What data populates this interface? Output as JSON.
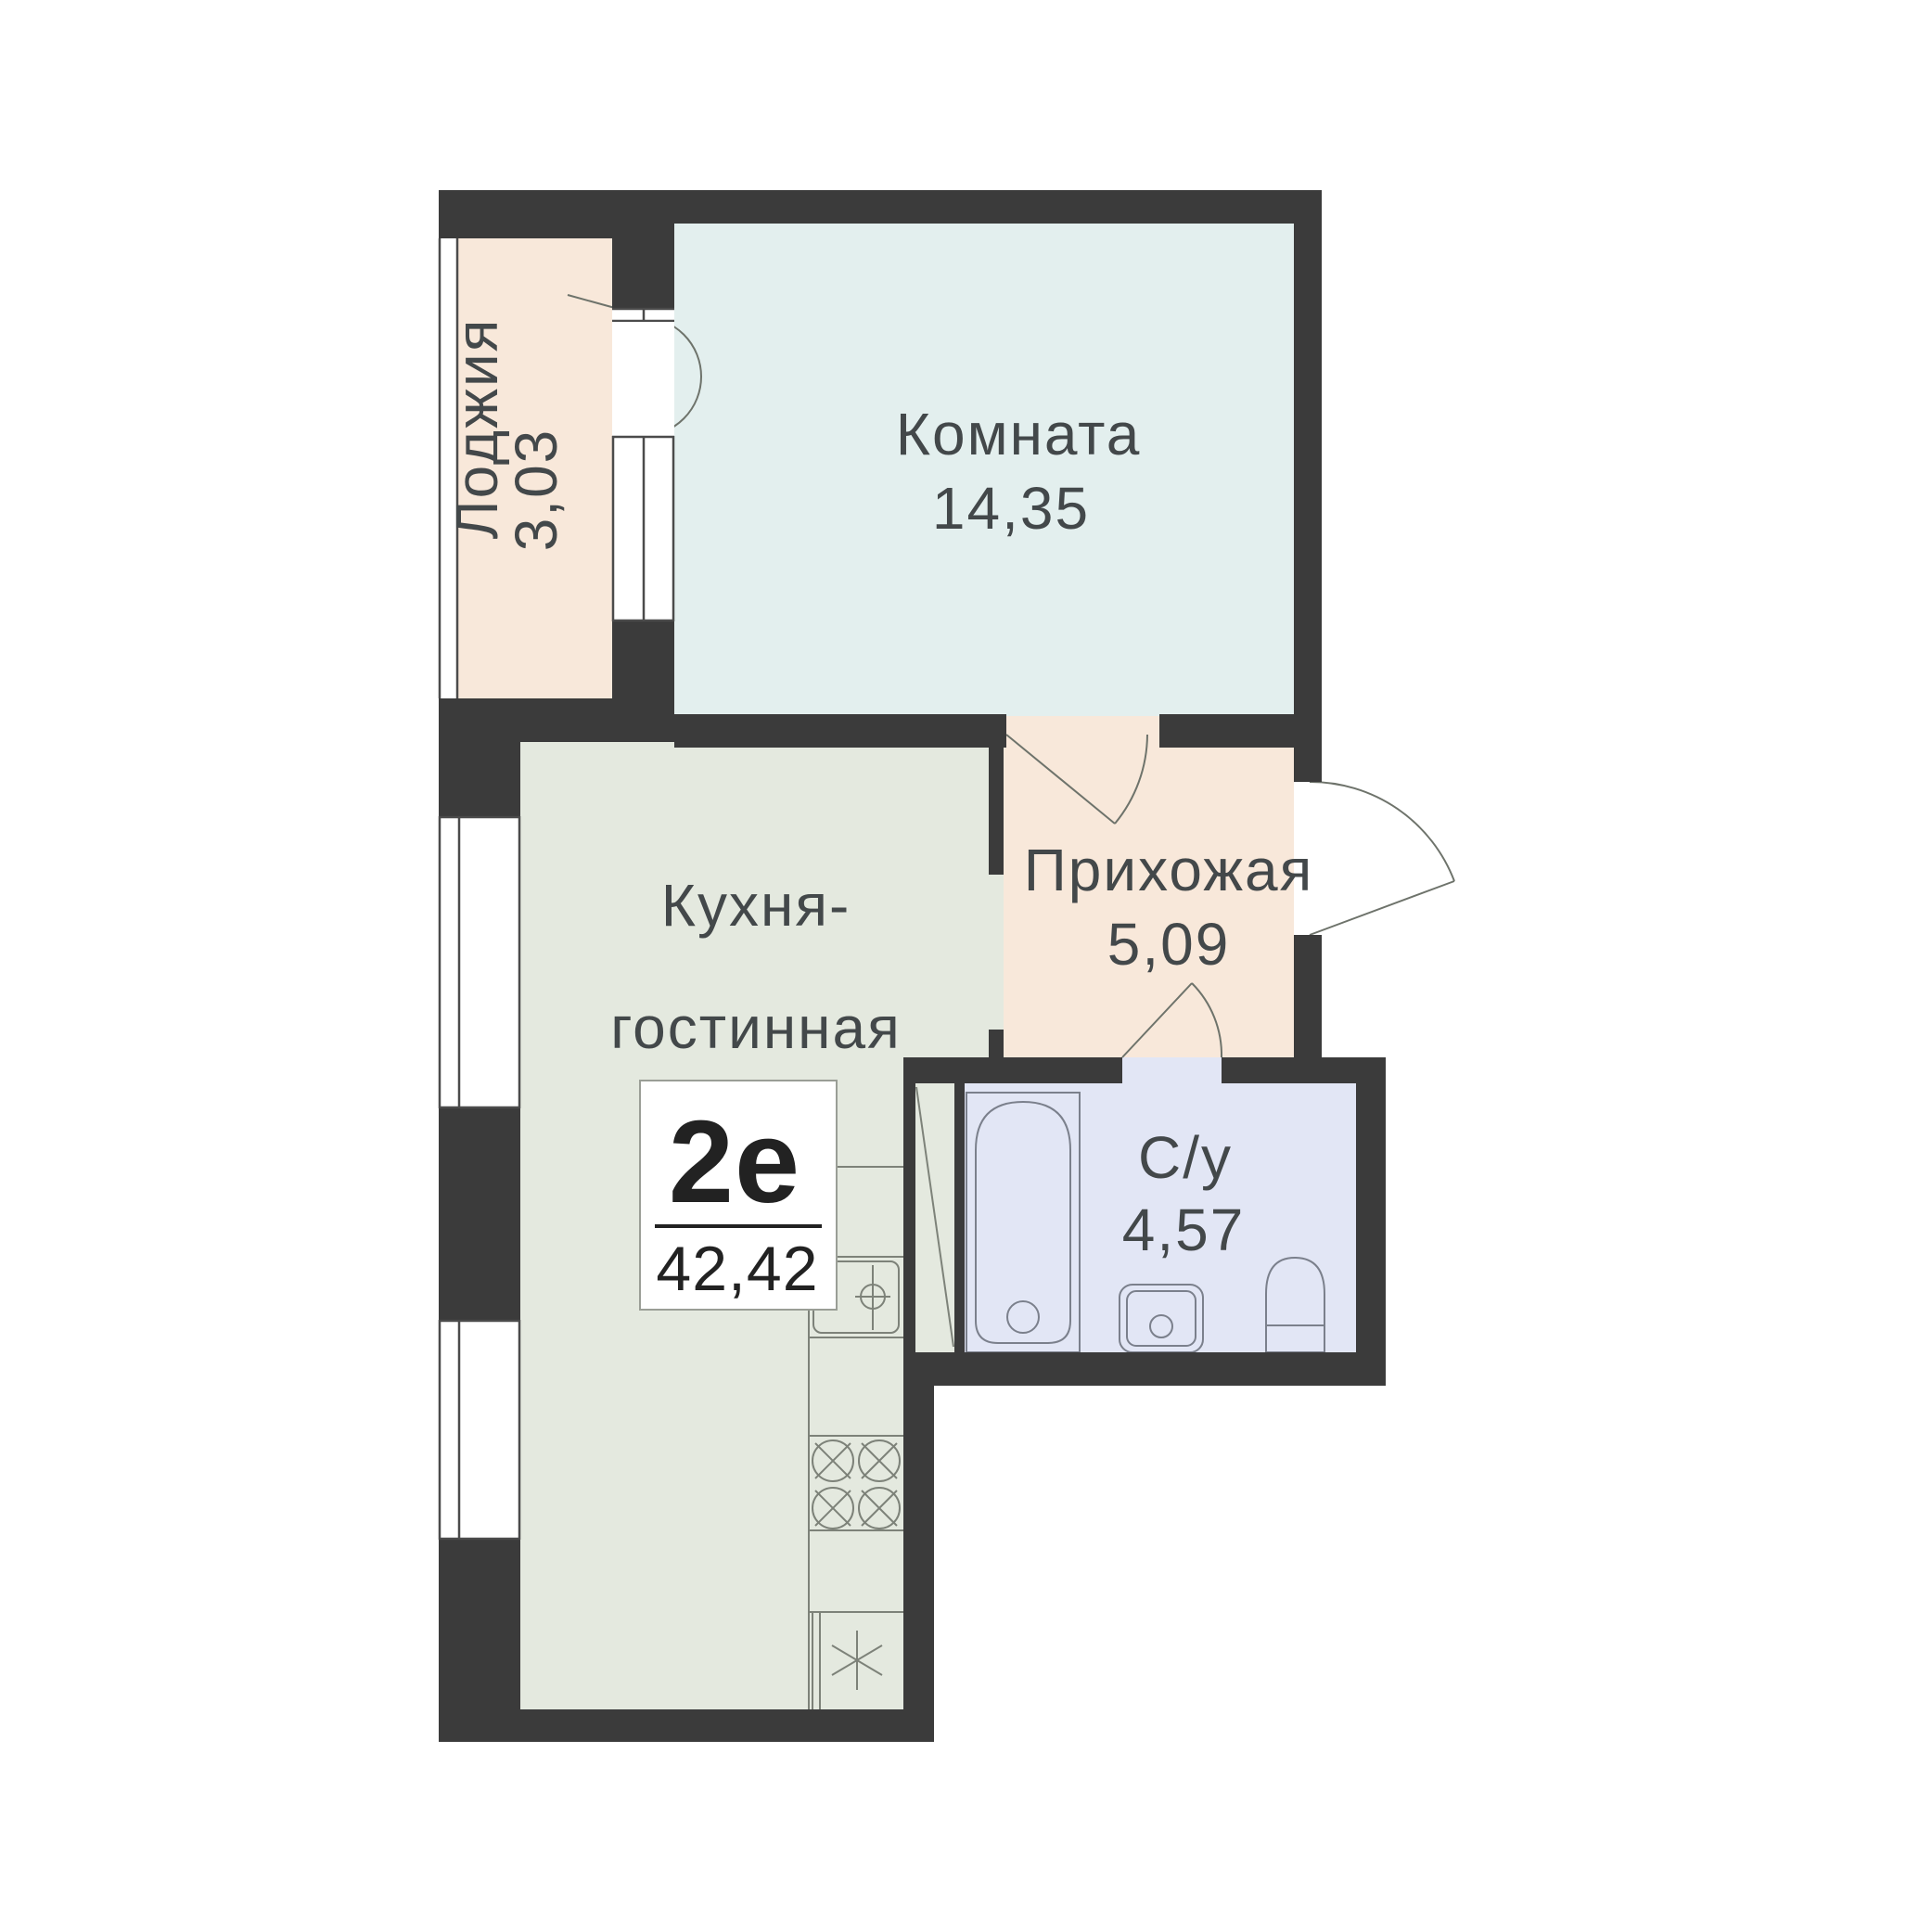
{
  "plan": {
    "title": "apartment-floor-plan",
    "type_badge": {
      "type": "2е",
      "total_area": "42,42"
    },
    "rooms": [
      {
        "id": "loggia",
        "label": "Лоджия",
        "area": "3,03"
      },
      {
        "id": "room",
        "label": "Комната",
        "area": "14,35"
      },
      {
        "id": "kitchen",
        "label_line1": "Кухня-",
        "label_line2": "гостинная",
        "area": "16,89"
      },
      {
        "id": "hallway",
        "label": "Прихожая",
        "area": "5,09"
      },
      {
        "id": "bathroom",
        "label": "С/у",
        "area": "4,57"
      }
    ],
    "colors": {
      "wall": "#3b3b3b",
      "room": "#e3efee",
      "kitchen": "#e4e9df",
      "hallway": "#f8e8da",
      "loggia": "#f8e8da",
      "bathroom": "#e2e6f5",
      "badge_bg": "#ffffff"
    }
  }
}
